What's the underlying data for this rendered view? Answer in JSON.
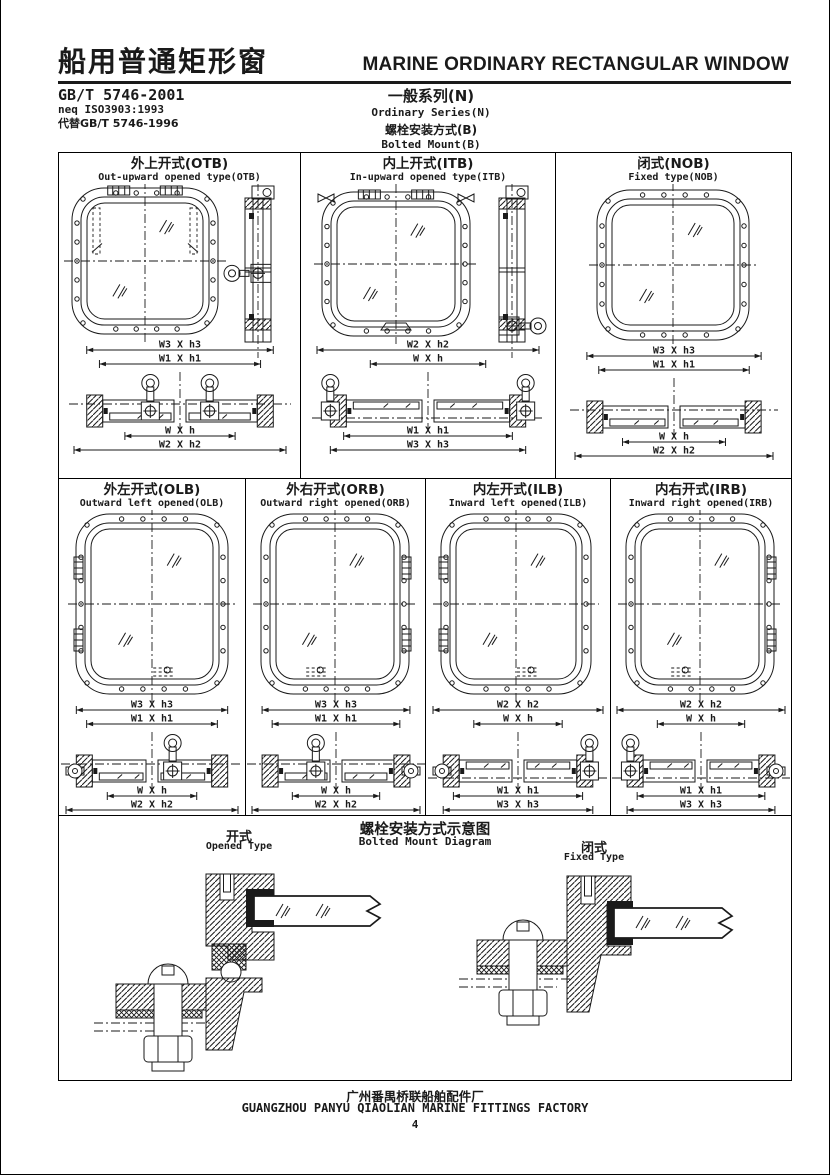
{
  "header": {
    "title_cn": "船用普通矩形窗",
    "title_en": "MARINE ORDINARY RECTANGULAR WINDOW",
    "standard": "GB/T 5746-2001",
    "neq": "neq ISO3903:1993",
    "replaces": "代替GB/T 5746-1996",
    "series_cn": "一般系列(N)",
    "series_en": "Ordinary Series(N)",
    "mount_cn": "螺栓安装方式(B)",
    "mount_en": "Bolted Mount(B)"
  },
  "cells": [
    {
      "id": "OTB",
      "title_cn": "外上开式(OTB)",
      "title_en": "Out-upward opened type(OTB)",
      "dims_top": [
        "W3 X h3",
        "W1 X h1"
      ],
      "dims_bottom": [
        "W X h",
        "W2 X h2"
      ]
    },
    {
      "id": "ITB",
      "title_cn": "内上开式(ITB)",
      "title_en": "In-upward opened type(ITB)",
      "dims_top": [
        "W2 X h2",
        "W X h"
      ],
      "dims_bottom": [
        "W1 X h1",
        "W3 X h3"
      ]
    },
    {
      "id": "NOB",
      "title_cn": "闭式(NOB)",
      "title_en": "Fixed type(NOB)",
      "dims_top": [
        "W3 X h3",
        "W1 X h1"
      ],
      "dims_bottom": [
        "W X h",
        "W2 X h2"
      ]
    },
    {
      "id": "OLB",
      "title_cn": "外左开式(OLB)",
      "title_en": "Outward left opened(OLB)",
      "dims_top": [
        "W3 X h3",
        "W1 X h1"
      ],
      "dims_bottom": [
        "W X h",
        "W2 X h2"
      ]
    },
    {
      "id": "ORB",
      "title_cn": "外右开式(ORB)",
      "title_en": "Outward right opened(ORB)",
      "dims_top": [
        "W3 X h3",
        "W1 X h1"
      ],
      "dims_bottom": [
        "W X h",
        "W2 X h2"
      ]
    },
    {
      "id": "ILB",
      "title_cn": "内左开式(ILB)",
      "title_en": "Inward left opened(ILB)",
      "dims_top": [
        "W2 X h2",
        "W X h"
      ],
      "dims_bottom": [
        "W1 X h1",
        "W3 X h3"
      ]
    },
    {
      "id": "IRB",
      "title_cn": "内右开式(IRB)",
      "title_en": "Inward right opened(IRB)",
      "dims_top": [
        "W2 X h2",
        "W X h"
      ],
      "dims_bottom": [
        "W1 X h1",
        "W3 X h3"
      ]
    }
  ],
  "diagram": {
    "title_cn": "螺栓安装方式示意图",
    "title_en": "Bolted Mount Diagram",
    "left_cn": "开式",
    "left_en": "Opened Type",
    "right_cn": "闭式",
    "right_en": "Fixed Type"
  },
  "footer": {
    "factory_cn": "广州番禺桥联船舶配件厂",
    "factory_en": "GUANGZHOU PANYU QIAOLIAN MARINE FITTINGS FACTORY",
    "page": "4"
  },
  "colors": {
    "ink": "#1a1a1a",
    "paper": "#ffffff"
  }
}
